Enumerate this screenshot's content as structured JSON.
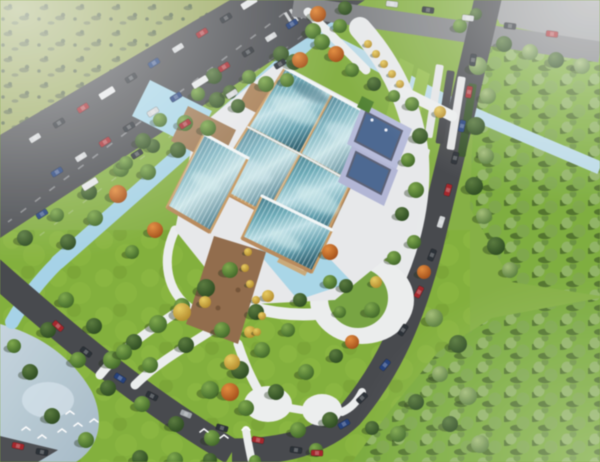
{
  "scene": {
    "description": "Aerial 3D architectural rendering: a cultural center with curved teal glass roofs and lavender roof terraces on a white plinth, surrounded by reflecting pools, timber decks, a landscaped park with winding white paths, water channels, a pond with birds, dense forests and roads with traffic",
    "style": "birds-eye-3d-render",
    "palette": {
      "grass_base": "#84ad43",
      "park_grass": "#81ad3a",
      "meadow_olive": "#99a75e",
      "forest_green": "#7cab3d",
      "road_dark": "#404246",
      "road_light": "#7b7d80",
      "pavement_corner": "#96989a",
      "water_channel": "#a6d2e6",
      "water_pale": "#bcdbe8",
      "pond": "#b7c9d5",
      "glass_dark": "#33637a",
      "glass_mid": "#69a7b4",
      "glass_light": "#c2e2e8",
      "roof_frame_tan": "#c59a64",
      "facade_tan": "#b5885a",
      "deck_brown": "#9c7853",
      "dirt_path_brown": "#8d6847",
      "plinth_white": "#e9eaec",
      "path_white": "#edefef",
      "terrace_lavender": "#b6bbd9",
      "terrace_inset_navy": "#46628c",
      "haze_white": "#ffffff"
    },
    "building": {
      "name": "glass-roof-cultural-center",
      "roof_sections": [
        "main-panel-nw",
        "main-panel-ne",
        "main-panel-se",
        "main-panel-sw",
        "west-wing",
        "south-wing"
      ],
      "features": [
        "curved-glass-roofs",
        "tan-frame-beams",
        "white-ridge-beams",
        "lavender-roof-terraces-with-navy-insets",
        "timber-decks",
        "reflecting-pools",
        "white-plinth-plaza",
        "entrance-steps"
      ]
    },
    "tree_colors": {
      "g": "green",
      "d": "dark-green",
      "o": "autumn-orange",
      "y": "autumn-yellow",
      "f": "forest-sage"
    },
    "trees": [
      [
        345,
        8,
        7,
        "d"
      ],
      [
        313,
        31,
        8,
        "g"
      ],
      [
        281,
        54,
        8,
        "d"
      ],
      [
        249,
        77,
        7,
        "g"
      ],
      [
        217,
        100,
        8,
        "d"
      ],
      [
        185,
        123,
        8,
        "g"
      ],
      [
        153,
        146,
        7,
        "d"
      ],
      [
        121,
        169,
        8,
        "g"
      ],
      [
        89,
        192,
        8,
        "d"
      ],
      [
        57,
        215,
        7,
        "g"
      ],
      [
        25,
        238,
        8,
        "d"
      ],
      [
        322,
        42,
        8,
        "g"
      ],
      [
        294,
        62,
        8,
        "d"
      ],
      [
        266,
        84,
        8,
        "g"
      ],
      [
        238,
        106,
        7,
        "d"
      ],
      [
        208,
        128,
        8,
        "g"
      ],
      [
        178,
        150,
        8,
        "d"
      ],
      [
        148,
        172,
        8,
        "g"
      ],
      [
        118,
        194,
        9,
        "o"
      ],
      [
        95,
        218,
        8,
        "g"
      ],
      [
        68,
        242,
        8,
        "d"
      ],
      [
        155,
        230,
        8,
        "o"
      ],
      [
        132,
        252,
        7,
        "g"
      ],
      [
        318,
        14,
        8,
        "o"
      ],
      [
        340,
        26,
        7,
        "g"
      ],
      [
        300,
        60,
        8,
        "o"
      ],
      [
        336,
        54,
        8,
        "o"
      ],
      [
        352,
        70,
        7,
        "g"
      ],
      [
        374,
        84,
        7,
        "d"
      ],
      [
        287,
        80,
        7,
        "g"
      ],
      [
        394,
        96,
        6,
        "g"
      ],
      [
        368,
        44,
        4,
        "y"
      ],
      [
        376,
        54,
        4,
        "y"
      ],
      [
        384,
        64,
        4,
        "y"
      ],
      [
        392,
        74,
        4,
        "y"
      ],
      [
        400,
        84,
        4,
        "y"
      ],
      [
        412,
        104,
        7,
        "g"
      ],
      [
        420,
        136,
        8,
        "d"
      ],
      [
        408,
        160,
        7,
        "g"
      ],
      [
        416,
        190,
        8,
        "g"
      ],
      [
        402,
        214,
        7,
        "d"
      ],
      [
        414,
        242,
        7,
        "g"
      ],
      [
        394,
        258,
        7,
        "g"
      ],
      [
        424,
        272,
        7,
        "o"
      ],
      [
        440,
        112,
        6,
        "y"
      ],
      [
        214,
        76,
        8,
        "d"
      ],
      [
        198,
        94,
        7,
        "g"
      ],
      [
        230,
        92,
        7,
        "d"
      ],
      [
        160,
        120,
        7,
        "g"
      ],
      [
        143,
        141,
        8,
        "d"
      ],
      [
        126,
        163,
        7,
        "g"
      ],
      [
        230,
        270,
        8,
        "g"
      ],
      [
        206,
        288,
        9,
        "d"
      ],
      [
        182,
        306,
        8,
        "g"
      ],
      [
        158,
        324,
        9,
        "g"
      ],
      [
        134,
        342,
        8,
        "d"
      ],
      [
        112,
        360,
        9,
        "g"
      ],
      [
        150,
        365,
        8,
        "g"
      ],
      [
        186,
        345,
        8,
        "d"
      ],
      [
        222,
        330,
        8,
        "g"
      ],
      [
        256,
        312,
        8,
        "d"
      ],
      [
        288,
        330,
        7,
        "g"
      ],
      [
        262,
        350,
        8,
        "g"
      ],
      [
        240,
        370,
        9,
        "d"
      ],
      [
        210,
        390,
        9,
        "g"
      ],
      [
        246,
        408,
        8,
        "g"
      ],
      [
        276,
        392,
        8,
        "d"
      ],
      [
        306,
        372,
        8,
        "g"
      ],
      [
        336,
        356,
        7,
        "d"
      ],
      [
        300,
        300,
        7,
        "d"
      ],
      [
        330,
        282,
        7,
        "g"
      ],
      [
        182,
        312,
        9,
        "y"
      ],
      [
        232,
        362,
        8,
        "y"
      ],
      [
        268,
        296,
        6,
        "y"
      ],
      [
        205,
        302,
        6,
        "y"
      ],
      [
        250,
        332,
        6,
        "y"
      ],
      [
        230,
        392,
        9,
        "o"
      ],
      [
        330,
        252,
        8,
        "o"
      ],
      [
        352,
        342,
        7,
        "o"
      ],
      [
        248,
        252,
        4,
        "y"
      ],
      [
        245,
        268,
        4,
        "y"
      ],
      [
        250,
        284,
        4,
        "y"
      ],
      [
        256,
        300,
        4,
        "y"
      ],
      [
        262,
        316,
        4,
        "y"
      ],
      [
        257,
        332,
        4,
        "y"
      ],
      [
        346,
        286,
        7,
        "d"
      ],
      [
        372,
        310,
        8,
        "g"
      ],
      [
        376,
        282,
        6,
        "y"
      ],
      [
        340,
        312,
        6,
        "g"
      ],
      [
        66,
        300,
        8,
        "g"
      ],
      [
        94,
        326,
        8,
        "d"
      ],
      [
        124,
        352,
        8,
        "g"
      ],
      [
        48,
        330,
        8,
        "d"
      ],
      [
        78,
        360,
        8,
        "g"
      ],
      [
        108,
        388,
        8,
        "d"
      ],
      [
        142,
        404,
        8,
        "g"
      ],
      [
        176,
        424,
        8,
        "d"
      ],
      [
        212,
        438,
        8,
        "g"
      ],
      [
        14,
        346,
        7,
        "g"
      ],
      [
        30,
        372,
        8,
        "d"
      ],
      [
        52,
        416,
        8,
        "d"
      ],
      [
        86,
        440,
        8,
        "g"
      ],
      [
        140,
        458,
        8,
        "d"
      ],
      [
        175,
        460,
        8,
        "g"
      ],
      [
        210,
        460,
        7,
        "d"
      ],
      [
        255,
        461,
        6,
        "g"
      ],
      [
        298,
        430,
        8,
        "g"
      ],
      [
        330,
        420,
        8,
        "d"
      ],
      [
        316,
        450,
        7,
        "g"
      ],
      [
        478,
        66,
        9,
        "f"
      ],
      [
        488,
        96,
        8,
        "f"
      ],
      [
        476,
        126,
        9,
        "d"
      ],
      [
        486,
        156,
        8,
        "f"
      ],
      [
        474,
        186,
        9,
        "d"
      ],
      [
        484,
        216,
        8,
        "f"
      ],
      [
        496,
        246,
        9,
        "d"
      ],
      [
        510,
        270,
        8,
        "f"
      ],
      [
        504,
        44,
        8,
        "d"
      ],
      [
        530,
        52,
        8,
        "f"
      ],
      [
        556,
        60,
        8,
        "d"
      ],
      [
        582,
        66,
        8,
        "f"
      ],
      [
        460,
        26,
        7,
        "g"
      ],
      [
        476,
        14,
        6,
        "d"
      ],
      [
        434,
        318,
        9,
        "f"
      ],
      [
        458,
        344,
        9,
        "d"
      ],
      [
        440,
        374,
        8,
        "f"
      ],
      [
        468,
        396,
        9,
        "f"
      ],
      [
        450,
        424,
        8,
        "d"
      ],
      [
        480,
        444,
        9,
        "f"
      ],
      [
        416,
        402,
        8,
        "d"
      ],
      [
        398,
        434,
        8,
        "g"
      ],
      [
        372,
        428,
        7,
        "d"
      ]
    ],
    "car_colors": {
      "w": "#d3d6d8",
      "k": "#23282e",
      "r": "#9c2025",
      "b": "#1e3a74",
      "t": "#e8eaeb",
      "s": "#9fa4a8"
    },
    "cars": [
      [
        249,
        3,
        -32,
        "t"
      ],
      [
        226,
        18,
        -32,
        "k"
      ],
      [
        202,
        33,
        -32,
        "r"
      ],
      [
        178,
        48,
        -32,
        "w"
      ],
      [
        154,
        63,
        -32,
        "b"
      ],
      [
        131,
        78,
        -32,
        "k"
      ],
      [
        107,
        93,
        -32,
        "t"
      ],
      [
        83,
        108,
        -32,
        "r"
      ],
      [
        59,
        123,
        -32,
        "k"
      ],
      [
        35,
        138,
        -32,
        "w"
      ],
      [
        292,
        24,
        -32,
        "b"
      ],
      [
        271,
        37,
        -32,
        "w"
      ],
      [
        248,
        52,
        -32,
        "k"
      ],
      [
        224,
        67,
        -32,
        "r"
      ],
      [
        200,
        82,
        -32,
        "t"
      ],
      [
        176,
        97,
        -32,
        "b"
      ],
      [
        153,
        112,
        -32,
        "w"
      ],
      [
        129,
        127,
        -32,
        "k"
      ],
      [
        105,
        142,
        -32,
        "r"
      ],
      [
        81,
        157,
        -32,
        "w"
      ],
      [
        57,
        172,
        -32,
        "b"
      ],
      [
        280,
        64,
        -32,
        "k"
      ],
      [
        232,
        94,
        -32,
        "w"
      ],
      [
        185,
        124,
        -32,
        "r"
      ],
      [
        137,
        154,
        -32,
        "k"
      ],
      [
        90,
        184,
        -32,
        "t"
      ],
      [
        42,
        214,
        -32,
        "b"
      ],
      [
        392,
        4,
        7,
        "w"
      ],
      [
        428,
        10,
        7,
        "k"
      ],
      [
        468,
        18,
        7,
        "w"
      ],
      [
        510,
        26,
        7,
        "k"
      ],
      [
        552,
        34,
        7,
        "r"
      ],
      [
        473,
        60,
        -82,
        "k"
      ],
      [
        469,
        92,
        -80,
        "r"
      ],
      [
        462,
        126,
        -78,
        "b"
      ],
      [
        455,
        158,
        -76,
        "k"
      ],
      [
        448,
        190,
        -74,
        "r"
      ],
      [
        441,
        222,
        -72,
        "w"
      ],
      [
        432,
        255,
        -68,
        "k"
      ],
      [
        419,
        292,
        -62,
        "r"
      ],
      [
        403,
        330,
        -56,
        "k"
      ],
      [
        385,
        365,
        -50,
        "b"
      ],
      [
        362,
        398,
        -44,
        "k"
      ],
      [
        344,
        424,
        -30,
        "b"
      ],
      [
        317,
        453,
        2,
        "r"
      ],
      [
        296,
        450,
        8,
        "k"
      ],
      [
        58,
        326,
        42,
        "r"
      ],
      [
        86,
        352,
        38,
        "k"
      ],
      [
        120,
        378,
        32,
        "b"
      ],
      [
        152,
        396,
        27,
        "k"
      ],
      [
        186,
        414,
        22,
        "s"
      ],
      [
        222,
        428,
        16,
        "k"
      ],
      [
        258,
        440,
        11,
        "r"
      ],
      [
        18,
        446,
        12,
        "r"
      ],
      [
        42,
        452,
        10,
        "k"
      ]
    ],
    "birds": [
      [
        26,
        428
      ],
      [
        42,
        436
      ],
      [
        62,
        430
      ],
      [
        78,
        424
      ],
      [
        94,
        420
      ],
      [
        70,
        412
      ],
      [
        204,
        430
      ],
      [
        224,
        436
      ],
      [
        246,
        428
      ]
    ],
    "parking_bars": [
      [
        436,
        64,
        "w"
      ],
      [
        447,
        70,
        "k"
      ],
      [
        458,
        76,
        "w"
      ],
      [
        469,
        83,
        "h"
      ]
    ],
    "parking_bar_colors": {
      "w": "#e6e7e8",
      "k": "#3b3d41",
      "h": "#2e4a20"
    }
  }
}
